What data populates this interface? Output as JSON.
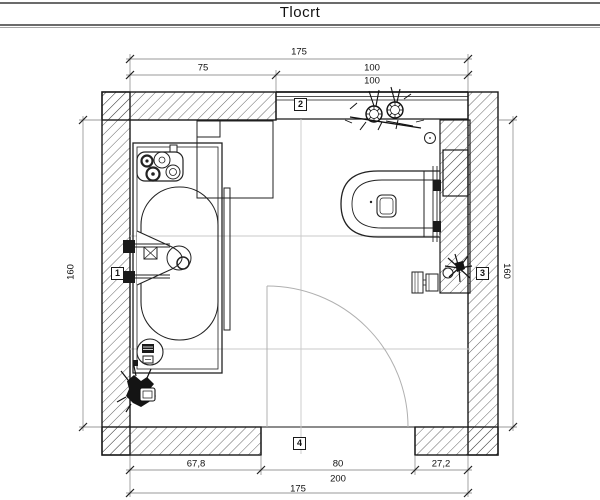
{
  "title": "Tlocrt",
  "colors": {
    "line": "#1a1a1a",
    "dim_line": "#9a9a9a",
    "reference_line": "#c9c9c9",
    "door_swing": "#b0b0b0",
    "background": "#ffffff"
  },
  "plan": {
    "dims": {
      "top_overall": "175",
      "top_segment_left": "75",
      "top_segment_right": "100",
      "window_note": "100",
      "left_height": "160",
      "right_height": "160",
      "bottom_segment_left": "67,8",
      "bottom_door_width": "80",
      "bottom_segment_right": "27,2",
      "door_note": "200",
      "bottom_overall": "175"
    },
    "markers": {
      "left": "1",
      "top": "2",
      "right": "3",
      "bottom": "4"
    }
  }
}
